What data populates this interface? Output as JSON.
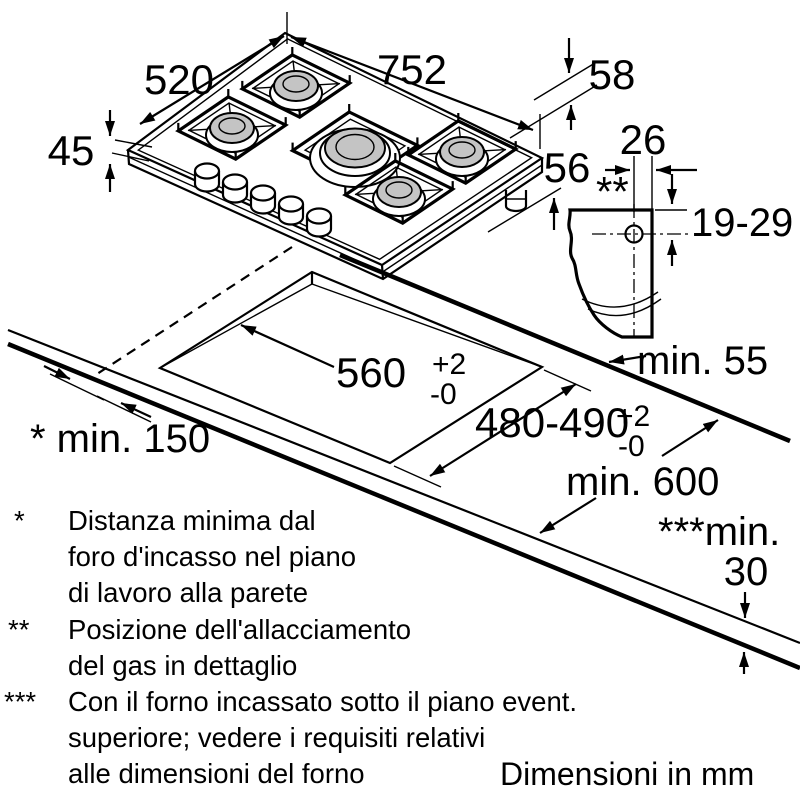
{
  "colors": {
    "ink": "#000000",
    "burner_cap": "#c4c4c4",
    "paper": "#ffffff"
  },
  "hob": {
    "width_mm": "752",
    "depth_mm": "520",
    "height_mm": "45",
    "gas_conn_offset_mm": "58",
    "gas_conn_drop_mm": "56"
  },
  "gas_detail": {
    "pipe_width_mm": "26",
    "marker": "**",
    "depth_range_mm": "19-29"
  },
  "cutout": {
    "width_mm": "560",
    "width_tol_plus": "+2",
    "width_tol_minus": "-0",
    "depth_mm": "480-490",
    "depth_tol_plus": "+2",
    "depth_tol_minus": "-0"
  },
  "clearances": {
    "rear_min": "min. 55",
    "side_min": "* min. 150",
    "worktop_min_depth": "min. 600",
    "below_min_label": "***min.",
    "below_min_value": "30"
  },
  "legend": {
    "items": [
      {
        "marker": "*",
        "lines": [
          "Distanza minima dal",
          "foro d'incasso nel piano",
          "di lavoro alla parete"
        ]
      },
      {
        "marker": "**",
        "lines": [
          "Posizione dell'allacciamento",
          "del gas in dettaglio"
        ]
      },
      {
        "marker": "***",
        "lines": [
          "Con il forno incassato sotto il piano event.",
          "superiore; vedere i requisiti relativi",
          "alle dimensioni del forno"
        ]
      }
    ],
    "units_note": "Dimensioni in mm"
  }
}
